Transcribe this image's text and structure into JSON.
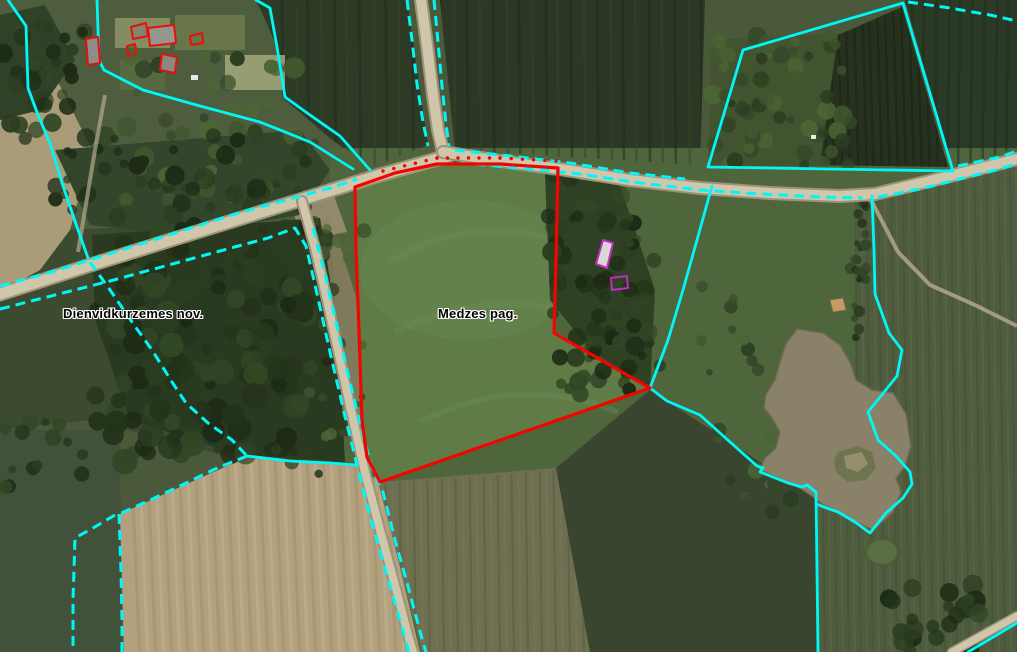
{
  "map": {
    "type": "cadastral-aerial-map",
    "labels": [
      {
        "id": "municipality-label",
        "text": "Dienvidkurzemes nov.",
        "x": 63,
        "y": 306
      },
      {
        "id": "parish-label",
        "text": "Medzes pag.",
        "x": 438,
        "y": 306
      }
    ],
    "colors": {
      "boundary": "#00f7f7",
      "parcel": "#f40400",
      "building_red": "#e8100c",
      "building_magenta": "#c32ac0",
      "label_text": "#000000",
      "label_halo": "#ffffff"
    },
    "features": {
      "selected_parcel": {
        "points": [
          [
            355,
            187
          ],
          [
            395,
            173
          ],
          [
            437,
            164
          ],
          [
            500,
            164
          ],
          [
            558,
            168
          ],
          [
            556,
            260
          ],
          [
            554,
            333
          ],
          [
            650,
            388
          ],
          [
            380,
            482
          ],
          [
            367,
            457
          ],
          [
            362,
            420
          ],
          [
            359,
            330
          ],
          [
            356,
            250
          ]
        ]
      },
      "parcel_dot_line": {
        "points": [
          [
            383,
            174
          ],
          [
            437,
            161
          ],
          [
            500,
            161
          ],
          [
            556,
            164
          ]
        ],
        "spacing": 10
      },
      "boundaries_solid": [
        {
          "points": [
            [
              8,
              0
            ],
            [
              26,
              26
            ],
            [
              28,
              88
            ],
            [
              38,
              115
            ],
            [
              50,
              143
            ],
            [
              62,
              183
            ],
            [
              77,
              227
            ],
            [
              88,
              258
            ]
          ]
        },
        {
          "points": [
            [
              97,
              0
            ],
            [
              99,
              60
            ],
            [
              104,
              70
            ],
            [
              143,
              90
            ],
            [
              200,
              106
            ],
            [
              260,
              122
            ],
            [
              310,
              142
            ],
            [
              353,
              169
            ]
          ]
        },
        {
          "points": [
            [
              256,
              0
            ],
            [
              270,
              8
            ],
            [
              277,
              47
            ],
            [
              285,
              97
            ],
            [
              310,
              115
            ],
            [
              340,
              136
            ],
            [
              370,
              170
            ]
          ]
        },
        {
          "points": [
            [
              708,
              167
            ],
            [
              743,
              50
            ],
            [
              903,
              3
            ],
            [
              953,
              171
            ],
            [
              708,
              167
            ]
          ]
        },
        {
          "points": [
            [
              872,
              196
            ],
            [
              874,
              250
            ],
            [
              875,
              294
            ],
            [
              889,
              333
            ],
            [
              902,
              350
            ],
            [
              897,
              376
            ],
            [
              868,
              412
            ],
            [
              878,
              440
            ],
            [
              896,
              456
            ],
            [
              910,
              472
            ],
            [
              912,
              484
            ],
            [
              903,
              498
            ],
            [
              886,
              513
            ],
            [
              870,
              533
            ],
            [
              855,
              522
            ],
            [
              838,
              512
            ],
            [
              824,
              507
            ],
            [
              816,
              504
            ]
          ]
        },
        {
          "points": [
            [
              712,
              186
            ],
            [
              697,
              240
            ],
            [
              683,
              290
            ],
            [
              668,
              340
            ],
            [
              650,
              388
            ],
            [
              667,
              401
            ],
            [
              700,
              415
            ],
            [
              730,
              442
            ],
            [
              757,
              466
            ],
            [
              763,
              468
            ],
            [
              760,
              472
            ],
            [
              788,
              483
            ],
            [
              802,
              487
            ],
            [
              807,
              485
            ],
            [
              812,
              489
            ],
            [
              816,
              492
            ],
            [
              817,
              570
            ],
            [
              818,
              652
            ]
          ]
        },
        {
          "points": [
            [
              247,
              456
            ],
            [
              290,
              461
            ],
            [
              330,
              463
            ],
            [
              356,
              465
            ]
          ]
        },
        {
          "points": [
            [
              968,
              652
            ],
            [
              1017,
              623
            ]
          ]
        }
      ],
      "boundaries_dashed": [
        {
          "points": [
            [
              0,
              286
            ],
            [
              55,
              271
            ],
            [
              115,
              252
            ],
            [
              175,
              233
            ],
            [
              235,
              214
            ],
            [
              290,
              199
            ],
            [
              330,
              188
            ],
            [
              357,
              179
            ]
          ]
        },
        {
          "points": [
            [
              0,
              309
            ],
            [
              55,
              295
            ],
            [
              110,
              281
            ],
            [
              165,
              266
            ],
            [
              220,
              251
            ],
            [
              268,
              238
            ],
            [
              295,
              228
            ],
            [
              306,
              246
            ],
            [
              318,
              298
            ],
            [
              330,
              352
            ],
            [
              344,
              412
            ],
            [
              357,
              465
            ],
            [
              371,
              520
            ],
            [
              386,
              572
            ],
            [
              400,
              620
            ],
            [
              409,
              652
            ]
          ]
        },
        {
          "points": [
            [
              313,
              228
            ],
            [
              324,
              270
            ],
            [
              336,
              322
            ],
            [
              349,
              378
            ],
            [
              362,
              432
            ],
            [
              372,
              468
            ],
            [
              383,
              492
            ],
            [
              395,
              540
            ],
            [
              409,
              590
            ],
            [
              421,
              635
            ],
            [
              426,
              652
            ]
          ]
        },
        {
          "points": [
            [
              407,
              0
            ],
            [
              412,
              40
            ],
            [
              417,
              84
            ],
            [
              423,
              122
            ],
            [
              428,
              146
            ]
          ]
        },
        {
          "points": [
            [
              434,
              0
            ],
            [
              438,
              42
            ],
            [
              442,
              86
            ],
            [
              446,
              124
            ],
            [
              449,
              146
            ]
          ]
        },
        {
          "points": [
            [
              455,
              150
            ],
            [
              510,
              156
            ],
            [
              570,
              163
            ],
            [
              630,
              173
            ],
            [
              685,
              179
            ]
          ]
        },
        {
          "points": [
            [
              460,
              163
            ],
            [
              520,
              168
            ],
            [
              580,
              174
            ],
            [
              640,
              183
            ],
            [
              700,
              190
            ],
            [
              760,
              194
            ],
            [
              820,
              197
            ],
            [
              862,
              198
            ]
          ]
        },
        {
          "points": [
            [
              958,
              166
            ],
            [
              1000,
              157
            ],
            [
              1017,
              151
            ]
          ]
        },
        {
          "points": [
            [
              878,
              197
            ],
            [
              920,
              189
            ],
            [
              960,
              179
            ],
            [
              1000,
              169
            ],
            [
              1017,
              163
            ]
          ]
        },
        {
          "points": [
            [
              90,
              262
            ],
            [
              110,
              290
            ],
            [
              132,
              322
            ],
            [
              152,
              350
            ],
            [
              172,
              382
            ],
            [
              186,
              403
            ],
            [
              208,
              423
            ],
            [
              232,
              440
            ],
            [
              247,
              456
            ]
          ]
        },
        {
          "points": [
            [
              247,
              456
            ],
            [
              215,
              469
            ],
            [
              180,
              486
            ],
            [
              148,
              501
            ],
            [
              119,
              514
            ]
          ]
        },
        {
          "points": [
            [
              119,
              514
            ],
            [
              121,
              570
            ],
            [
              122,
              620
            ],
            [
              122,
              652
            ]
          ]
        },
        {
          "points": [
            [
              115,
              515
            ],
            [
              93,
              528
            ],
            [
              75,
              538
            ],
            [
              73,
              600
            ],
            [
              73,
              652
            ]
          ]
        },
        {
          "points": [
            [
              908,
              2
            ],
            [
              950,
              8
            ],
            [
              990,
              15
            ],
            [
              1017,
              21
            ]
          ]
        }
      ],
      "buildings_red": [
        {
          "points": [
            [
              86,
              39
            ],
            [
              98,
              37
            ],
            [
              100,
              63
            ],
            [
              88,
              65
            ]
          ],
          "fill": "#8d8d89"
        },
        {
          "points": [
            [
              131,
              27
            ],
            [
              146,
              23
            ],
            [
              148,
              36
            ],
            [
              133,
              39
            ]
          ],
          "fill": "#83836e"
        },
        {
          "points": [
            [
              148,
              28
            ],
            [
              174,
              25
            ],
            [
              176,
              43
            ],
            [
              150,
              46
            ]
          ],
          "fill": "#96968f"
        },
        {
          "points": [
            [
              190,
              36
            ],
            [
              202,
              33
            ],
            [
              203,
              43
            ],
            [
              191,
              45
            ]
          ],
          "fill": "none"
        },
        {
          "points": [
            [
              127,
              46
            ],
            [
              135,
              44
            ],
            [
              136,
              54
            ],
            [
              128,
              56
            ]
          ],
          "fill": "none"
        },
        {
          "points": [
            [
              162,
              54
            ],
            [
              177,
              57
            ],
            [
              175,
              73
            ],
            [
              160,
              70
            ]
          ],
          "fill": "#8a8a80"
        }
      ],
      "buildings_magenta": [
        {
          "points": [
            [
              603,
              240
            ],
            [
              613,
              243
            ],
            [
              607,
              268
            ],
            [
              596,
              264
            ]
          ],
          "fill": "#d8d8d4"
        },
        {
          "points": [
            [
              611,
              278
            ],
            [
              627,
              276
            ],
            [
              628,
              288
            ],
            [
              612,
              290
            ]
          ],
          "fill": "none"
        }
      ]
    }
  }
}
